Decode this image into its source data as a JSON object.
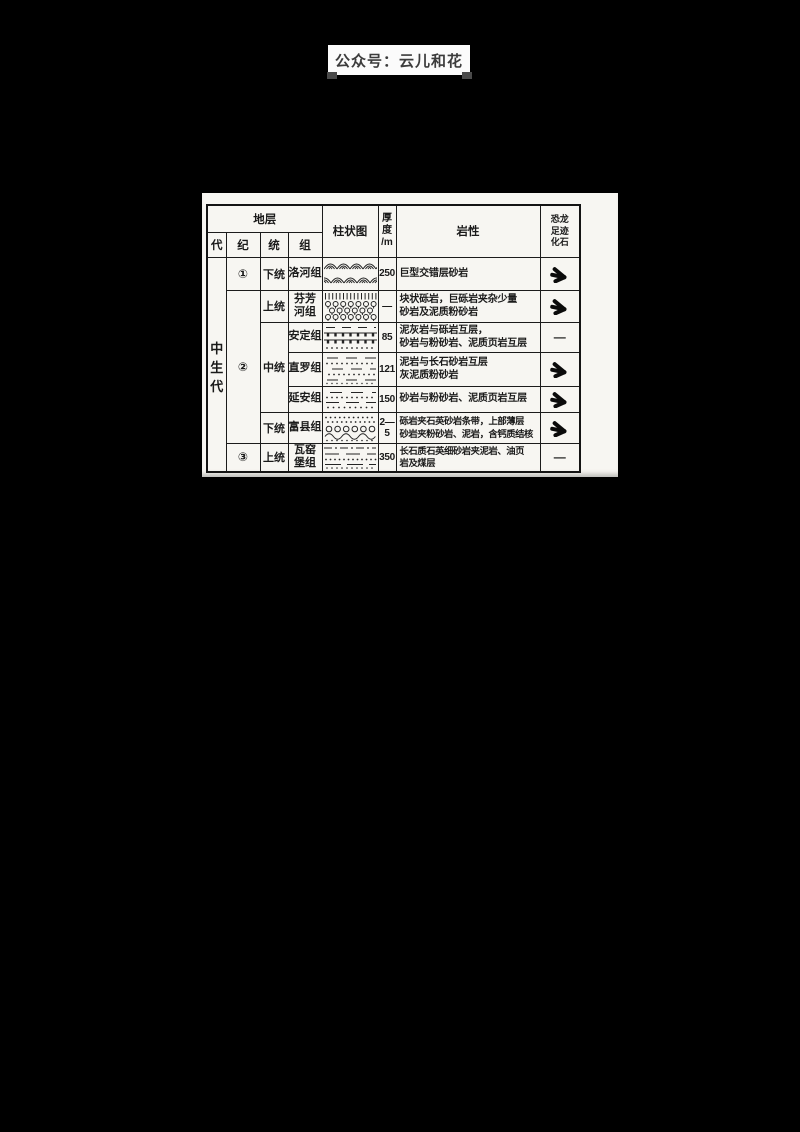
{
  "page": {
    "background": "#000000",
    "paper_color": "#f7f6f2",
    "ink_color": "#1a1a1a"
  },
  "watermark": {
    "text": "公众号：云儿和花"
  },
  "table": {
    "headers": {
      "strata": "地层",
      "era": "代",
      "period": "纪",
      "series": "统",
      "formation": "组",
      "column_diagram": "柱状图",
      "thickness_lines": [
        "厚",
        "度",
        "/m"
      ],
      "lithology": "岩性",
      "fossil_lines": [
        "恐龙",
        "足迹",
        "化石"
      ]
    },
    "era": "中生代",
    "era_chars": [
      "中",
      "生",
      "代"
    ],
    "periods": [
      "①",
      "②",
      "③"
    ],
    "series": [
      "下统",
      "上统",
      "中统",
      "下统",
      "上统"
    ],
    "rows": [
      {
        "formation_lines": [
          "洛河组"
        ],
        "pattern": "cross-bedded-sandstone",
        "thickness": "250",
        "lithology_lines": [
          "巨型交错层砂岩"
        ],
        "fossil": "footprint"
      },
      {
        "formation_lines": [
          "芬芳",
          "河组"
        ],
        "pattern": "conglomerate",
        "thickness": "—",
        "lithology_lines": [
          "块状砾岩，巨砾岩夹杂少量",
          "砂岩及泥质粉砂岩"
        ],
        "fossil": "footprint"
      },
      {
        "formation_lines": [
          "安定组"
        ],
        "pattern": "marl-breccia",
        "thickness": "85",
        "lithology_lines": [
          "泥灰岩与砾岩互层，",
          "砂岩与粉砂岩、泥质页岩互层"
        ],
        "fossil": "—"
      },
      {
        "formation_lines": [
          "直罗组"
        ],
        "pattern": "mudstone-sandstone",
        "thickness": "121",
        "lithology_lines": [
          "泥岩与长石砂岩互层",
          "灰泥质粉砂岩"
        ],
        "fossil": "footprint"
      },
      {
        "formation_lines": [
          "延安组"
        ],
        "pattern": "sandstone-siltstone",
        "thickness": "150",
        "lithology_lines": [
          "砂岩与粉砂岩、泥质页岩互层"
        ],
        "fossil": "footprint"
      },
      {
        "formation_lines": [
          "富县组"
        ],
        "pattern": "gravel-wave",
        "thickness": "2—5",
        "lithology_lines": [
          "砾岩夹石英砂岩条带，上部薄层",
          "砂岩夹粉砂岩、泥岩，含钙质结核"
        ],
        "fossil": "footprint"
      },
      {
        "formation_lines": [
          "瓦窑",
          "堡组"
        ],
        "pattern": "coal-series",
        "thickness": "350",
        "lithology_lines": [
          "长石质石英细砂岩夹泥岩、油页",
          "岩及煤层"
        ],
        "fossil": "—"
      }
    ]
  }
}
